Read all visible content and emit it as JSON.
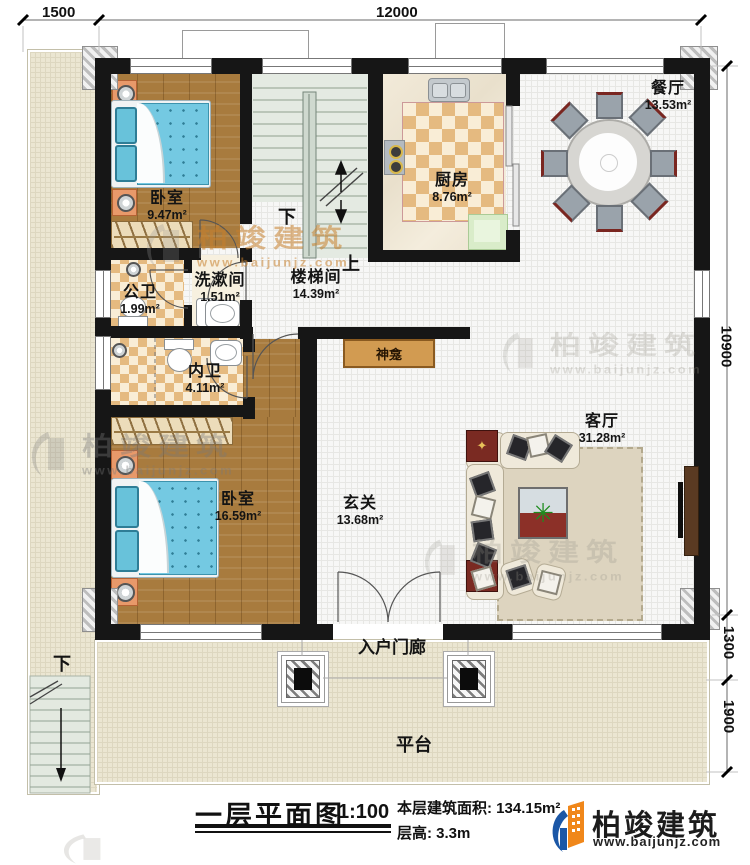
{
  "dimensions": {
    "top_left": "1500",
    "top_main": "12000",
    "right_upper": "10900",
    "right_mid": "1300",
    "right_lower": "1900"
  },
  "rooms": {
    "bedroom1": {
      "name": "卧室",
      "area": "9.47m²"
    },
    "washroom": {
      "name": "洗漱间",
      "area": "1.51m²"
    },
    "stairwell": {
      "name": "楼梯间",
      "area": "14.39m²"
    },
    "public_wc": {
      "name": "公卫",
      "area": "1.99m²"
    },
    "ensuite_wc": {
      "name": "内卫",
      "area": "4.11m²"
    },
    "bedroom2": {
      "name": "卧室",
      "area": "16.59m²"
    },
    "kitchen": {
      "name": "厨房",
      "area": "8.76m²"
    },
    "dining": {
      "name": "餐厅",
      "area": "13.53m²"
    },
    "entry": {
      "name": "玄关",
      "area": "13.68m²"
    },
    "living": {
      "name": "客厅",
      "area": "31.28m²"
    }
  },
  "annotations": {
    "stair_down": "下",
    "stair_up": "上",
    "terrace_down": "下",
    "shrine": "神龛",
    "porch": "入户门廊",
    "platform": "平台"
  },
  "title_block": {
    "title": "一层平面图",
    "scale": "1:100",
    "area_label": "本层建筑面积:",
    "area_value": "134.15m²",
    "floor_height_label": "层高:",
    "floor_height_value": "3.3m"
  },
  "brand": {
    "name": "柏竣建筑",
    "website": "www.baijunjz.com"
  },
  "watermark": {
    "text": "柏竣建筑",
    "website": "www.baijunjz.com"
  },
  "colors": {
    "wall": "#161616",
    "wood_floor": "#a87b3e",
    "tile_accent": "#e5ba80",
    "bed_blue": "#74c9e2",
    "brand_blue": "#1b57a6",
    "brand_orange": "#f0871a"
  }
}
